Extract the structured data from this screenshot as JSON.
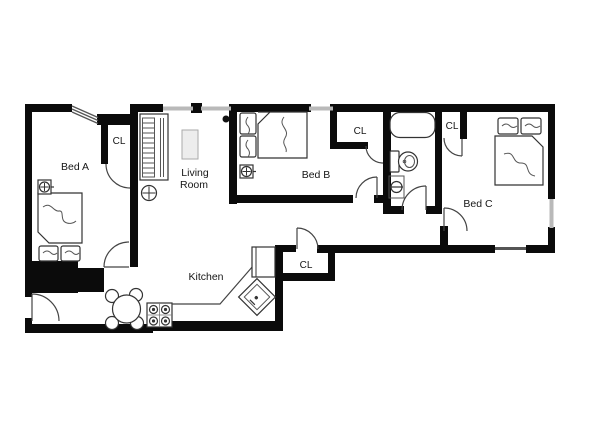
{
  "title": "Apartment floor plan",
  "colors": {
    "wall": "#0b0b0b",
    "window": "#b9b9b9",
    "door_line": "#444444",
    "fixture_line": "#333333",
    "text": "#161616",
    "table_fill": "#ededed",
    "background": "#ffffff"
  },
  "rooms": {
    "bed_a": {
      "label": "Bed A"
    },
    "bed_b": {
      "label": "Bed B"
    },
    "bed_c": {
      "label": "Bed C"
    },
    "living_room": {
      "line1": "Living",
      "line2": "Room"
    },
    "kitchen": {
      "label": "Kitchen"
    },
    "closets": {
      "bed_a_cl": "CL",
      "bed_b_cl": "CL",
      "bed_c_cl": "CL",
      "kitchen_cl": "CL"
    }
  },
  "fixtures": {
    "bed_a": "bed-icon",
    "bed_b": "bed-icon",
    "bed_c": "bed-icon",
    "bathtub": "bathtub-icon",
    "toilet": "toilet-icon",
    "bath_sink": "sink-icon",
    "kitchen_sink": "kitchen-sink-icon",
    "stove": "stove-icon",
    "dining_table": "dining-table-icon",
    "refrigerator": "refrigerator-icon",
    "radiator": "radiator-icon",
    "coffee_table": "table-icon",
    "ceiling_light": "ceiling-light-icon",
    "thermostat_a": "thermostat-icon",
    "thermostat_b": "thermostat-icon",
    "thermostat_lr": "thermostat-icon"
  }
}
